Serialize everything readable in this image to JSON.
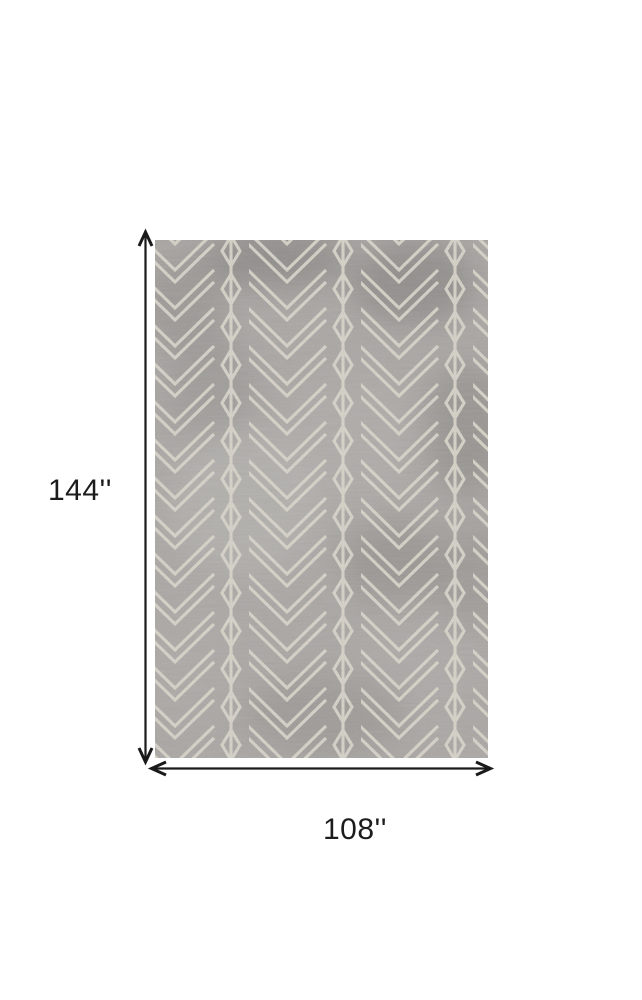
{
  "page": {
    "background_color": "#ffffff"
  },
  "diagram": {
    "kind": "rug-dimension-diagram",
    "height_label": "144''",
    "width_label": "108''",
    "label_color": "#1c1c1c",
    "arrows": {
      "color": "#1a1a1a"
    },
    "rug": {
      "description": "Gray area rug with ivory geometric chevron lattice pattern",
      "base_color": "#a9a6a3",
      "pattern_line_color": "#d9d5cb",
      "dark_patch_color": "#7a7674",
      "light_patch_color": "#b9b6b2"
    }
  }
}
